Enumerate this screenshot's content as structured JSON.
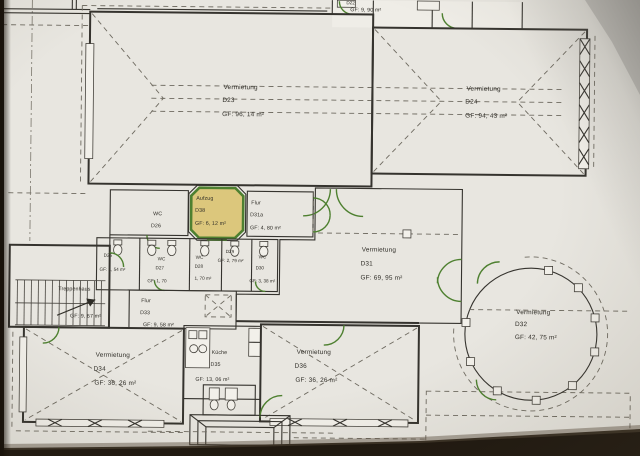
{
  "document": {
    "type": "architectural-floor-plan-photo",
    "colors": {
      "room_fill": "#dcc77c",
      "accent_green": "#4e8030",
      "paper": "#e8e6e0",
      "line": "#35332e"
    }
  },
  "rooms": {
    "d22": {
      "id": "D22",
      "area": "GF: 9, 90 m²"
    },
    "d23": {
      "name": "Vermietung",
      "id": "D23",
      "area": "GF: 96, 14 m²"
    },
    "d24": {
      "name": "Vermietung",
      "id": "D24",
      "area": "GF: 94, 43 m²"
    },
    "d25": {
      "id": "D25",
      "area": "GF: 1, 54 m²"
    },
    "d26": {
      "name": "WC",
      "id": "D26"
    },
    "d27": {
      "name": "WC",
      "id": "D27",
      "area": "GF: 1, 70"
    },
    "d28": {
      "name": "WC",
      "id": "D28",
      "area": "1, 70 m²"
    },
    "d29": {
      "id": "D29",
      "area": "GF: 2, 79 m²"
    },
    "d30": {
      "name": "WC",
      "id": "D30",
      "area": "GF: 3, 38 m²"
    },
    "d31": {
      "name": "Vermietung",
      "id": "D31",
      "area": "GF: 69, 95 m²"
    },
    "d31a": {
      "name": "Flur",
      "id": "D31a",
      "area": "GF: 4, 80 m²"
    },
    "d32": {
      "name": "Vermietung",
      "id": "D32",
      "area": "GF: 42, 75 m²"
    },
    "d33": {
      "name": "Flur",
      "id": "D33",
      "area": "GF: 9, 58 m²"
    },
    "d34": {
      "name": "Vermietung",
      "id": "D34",
      "area": "GF: 36, 26 m²"
    },
    "d35": {
      "name": "Küche",
      "id": "D35",
      "area": "GF: 13, 06 m²"
    },
    "d36": {
      "name": "Vermietung",
      "id": "D36",
      "area": "GF: 36, 26 m²"
    },
    "d38": {
      "name": "Aufzug",
      "id": "D38",
      "area": "GF: 6, 12 m²"
    },
    "treppenhaus": {
      "name": "Treppenhaus",
      "area": "GF: 9, 67 m²"
    }
  }
}
